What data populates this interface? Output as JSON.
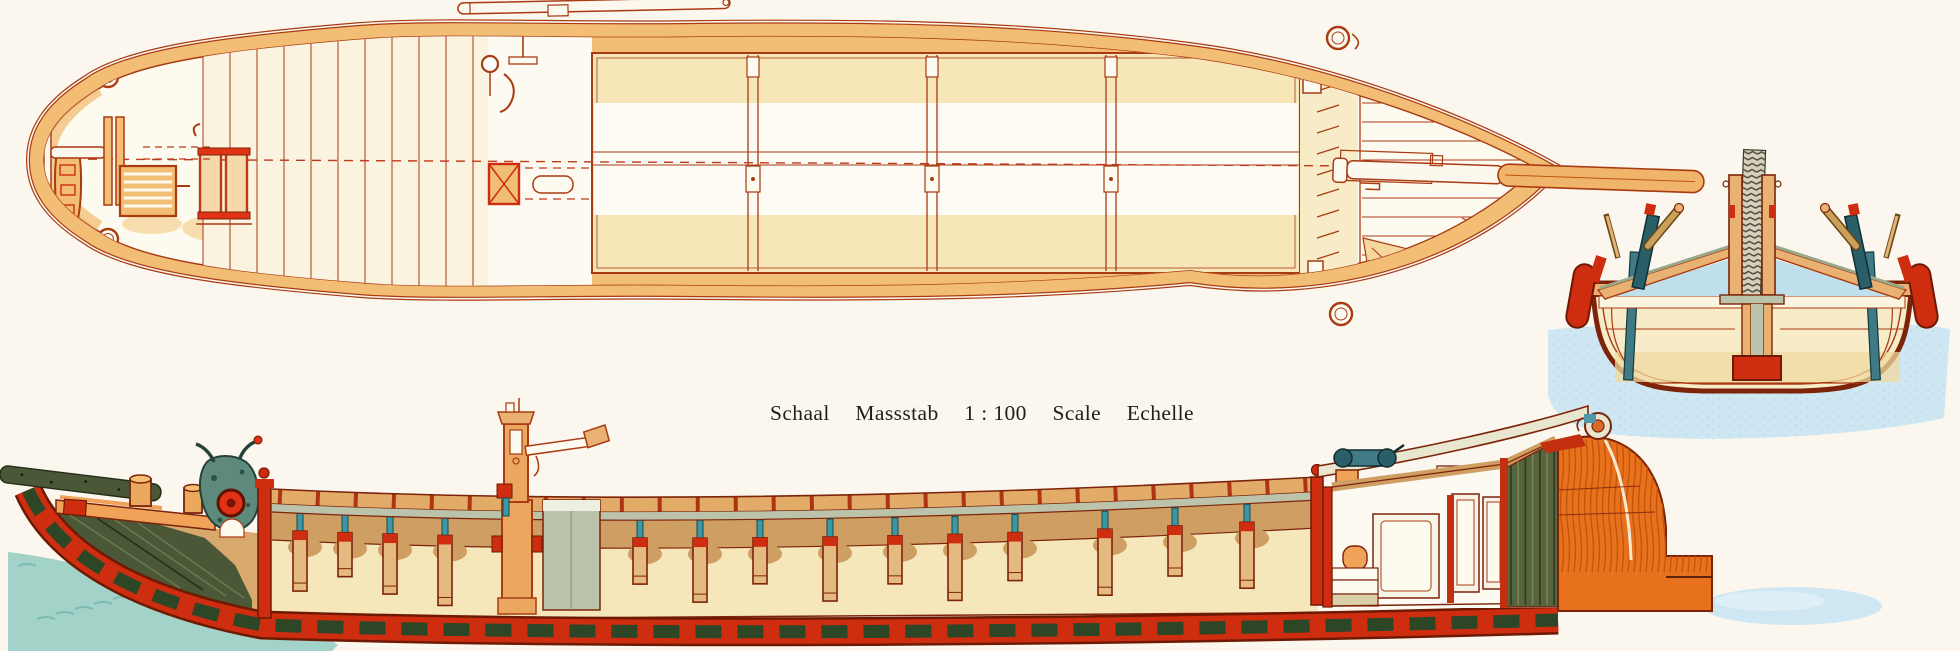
{
  "caption": {
    "words": [
      "Schaal",
      "Massstab",
      "1 : 100",
      "Scale",
      "Echelle"
    ]
  },
  "colors": {
    "paper": "#fbf7ee",
    "text": "#221d15",
    "ink": "#a93a12",
    "ink_dark": "#7c230a",
    "tan": "#f2bd74",
    "tan_soft": "#f6d79e",
    "pale_yellow": "#f7e6b8",
    "cream": "#fdfaf0",
    "hold_cream": "#f6e7bb",
    "coaming_tan": "#e2ac68",
    "hold_tan": "#cf9e63",
    "post_tan": "#e5ba80",
    "deck_orange": "#efa258",
    "orange": "#e8711d",
    "orange_deep": "#c2540a",
    "red": "#cf2d10",
    "red_bright": "#e03315",
    "red_dark": "#6e1a03",
    "block_green": "#2c4626",
    "olive": "#4a5837",
    "olive_dark": "#252f18",
    "sage": "#bcc3ab",
    "teal": "#3f7a85",
    "teal_dark": "#2b5f68",
    "teal_pin": "#3c98a5",
    "rail_cream": "#e9e6cf",
    "water_teal": "#a3d2c9",
    "water_teal_dark": "#76b8ac",
    "water_blue": "#cfe7f2",
    "water_blue_deep": "#b5d9ea"
  }
}
